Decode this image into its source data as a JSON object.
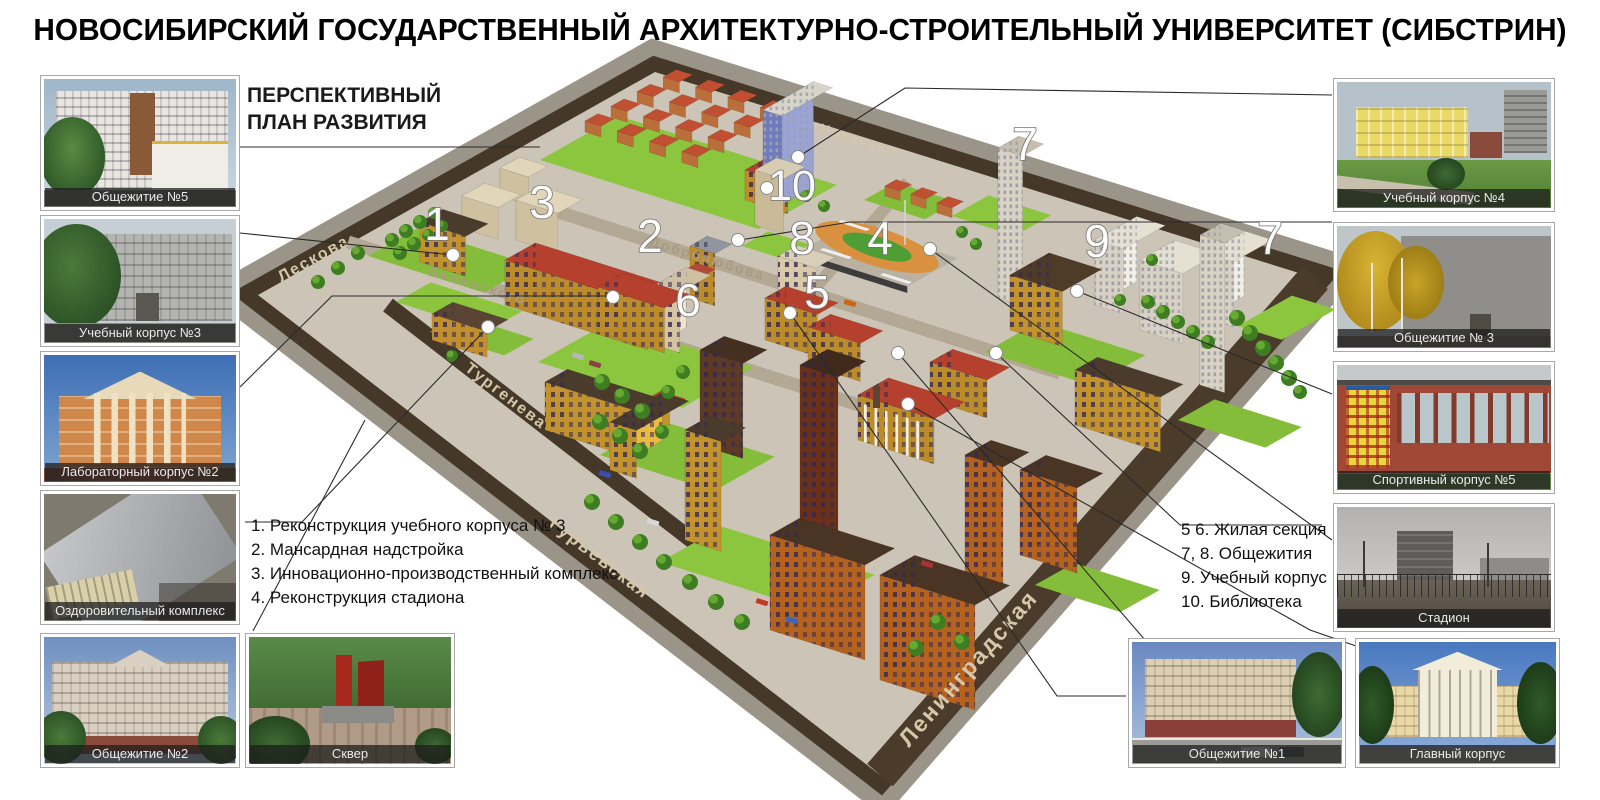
{
  "title": "НОВОСИБИРСКИЙ ГОСУДАРСТВЕННЫЙ АРХИТЕКТУРНО-СТРОИТЕЛЬНЫЙ УНИВЕРСИТЕТ (СИБСТРИН)",
  "subtitle": {
    "line1": "ПЕРСПЕКТИВНЫЙ",
    "line2": "ПЛАН РАЗВИТИЯ"
  },
  "legend_left": {
    "items": [
      "1. Реконструкция учебного корпуса № 3",
      "2. Мансардная надстройка",
      "3. Инновационно-производственный комплекс",
      "4. Реконструкция стадиона"
    ]
  },
  "legend_right": {
    "items": [
      "5 6. Жилая секция",
      "7, 8. Общежития",
      "9. Учебный корпус",
      "10. Библиотека"
    ]
  },
  "photos": [
    {
      "caption": "Общежитие №5"
    },
    {
      "caption": "Учебный корпус №3"
    },
    {
      "caption": "Лабораторный корпус №2"
    },
    {
      "caption": "Оздоровительный комплекс"
    },
    {
      "caption": "Общежитие №2"
    },
    {
      "caption": "Сквер"
    },
    {
      "caption": "Учебный корпус №4"
    },
    {
      "caption": "Общежитие № 3"
    },
    {
      "caption": "Спортивный корпус №5"
    },
    {
      "caption": "Стадион"
    },
    {
      "caption": "Общежитие №1"
    },
    {
      "caption": "Главный корпус"
    }
  ],
  "map": {
    "streets": [
      {
        "name": "Лескова"
      },
      {
        "name": "Белинского"
      },
      {
        "name": "Добролюбова"
      },
      {
        "name": "Тургенева"
      },
      {
        "name": "Никитина"
      },
      {
        "name": "Гурьевская"
      },
      {
        "name": "Ленинградская"
      }
    ],
    "markers": [
      {
        "label": "1"
      },
      {
        "label": "2"
      },
      {
        "label": "3"
      },
      {
        "label": "4"
      },
      {
        "label": "5"
      },
      {
        "label": "6"
      },
      {
        "label": "7"
      },
      {
        "label": "7"
      },
      {
        "label": "8"
      },
      {
        "label": "9"
      },
      {
        "label": "10"
      }
    ],
    "colors": {
      "lawn": "#8cc63e",
      "ground": "#ccc4b6",
      "road_dark": "#453828",
      "asphalt": "#9b9489",
      "roof_red": "#b5402e"
    }
  }
}
